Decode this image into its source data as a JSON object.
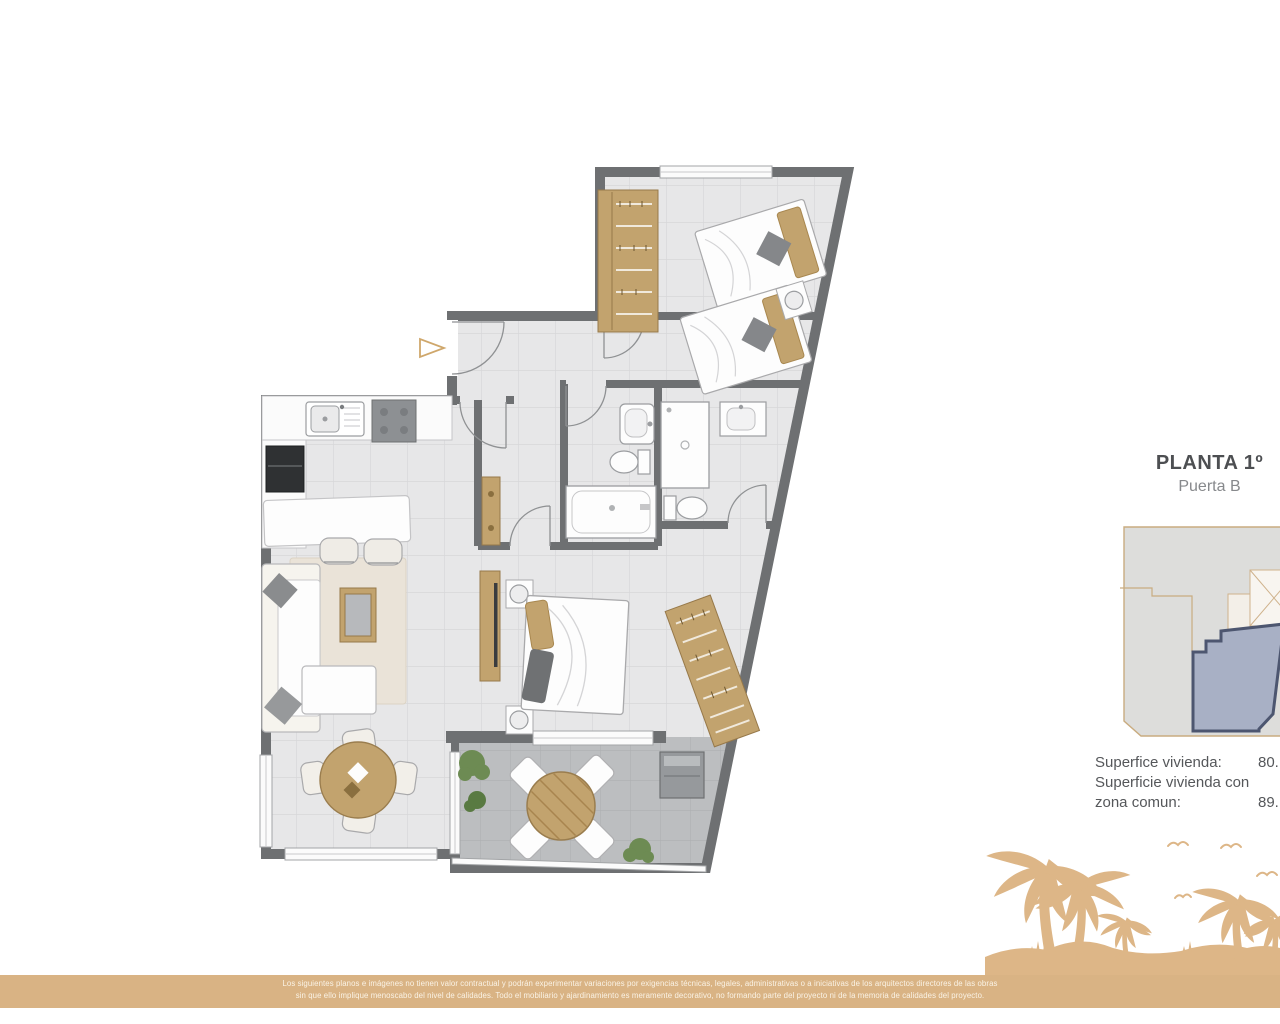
{
  "plan": {
    "entrance_marker_icon": "triangle-right",
    "palette": {
      "wall": "#6e7072",
      "floor": "#e7e7e8",
      "floor_grid": "#d7d7d9",
      "terrace_floor": "#bcbec0",
      "wood": "#c2a36e",
      "wood_dark": "#97794a",
      "rug": "#eae3d8",
      "plant": "#6d8b53",
      "appliance_dark": "#2f3133"
    }
  },
  "info_panel": {
    "title": "PLANTA 1º",
    "subtitle": "Puerta B",
    "surface": {
      "row1_label": "Superfice vivienda:",
      "row1_value": "80.",
      "row2_label_line1": "Superficie vivienda con",
      "row2_label_line2": "zona comun:",
      "row2_value": "89."
    }
  },
  "minimap": {
    "building_fill": "#dddddb",
    "building_stroke": "#c9ac80",
    "highlight_fill": "#a8b0c5",
    "highlight_stroke": "#4d5670"
  },
  "footer": {
    "band_color": "#d9b384",
    "art_color": "#ddb687",
    "disclaimer_line1": "Los siguientes planos e imágenes no tienen valor contractual y podrán experimentar variaciones por exigencias técnicas, legales, administrativas o a iniciativas de los arquitectos directores de las obras",
    "disclaimer_line2": "sin que ello implique menoscabo del nivel de calidades. Todo el mobiliario y ajardinamiento es meramente decorativo, no formando parte del proyecto ni de la memoria de calidades del proyecto."
  }
}
